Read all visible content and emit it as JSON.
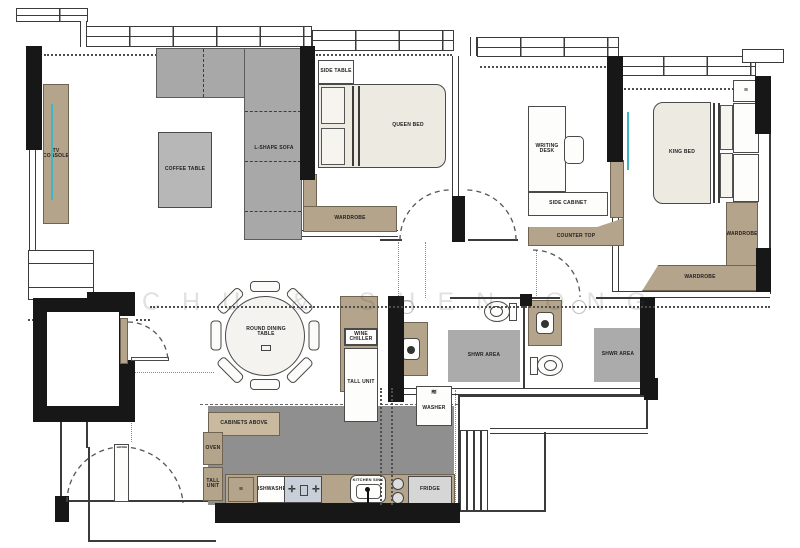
{
  "watermark": "CHU & SHEN ONG",
  "colors": {
    "wall": "#171717",
    "wood_tan": "#b4a48b",
    "upholstery_gray": "#a8a8a8",
    "bed_cream": "#edeae2",
    "accent_cyan": "#3fb6c4",
    "kitchen_floor": "#8f8f8f",
    "watermark_gray": "#d6d6d6"
  },
  "living": {
    "tv_console": "TV CONSOLE",
    "coffee_table": "COFFEE TABLE",
    "sofa": "L-SHAPE SOFA"
  },
  "bedroom2": {
    "side_table": "SIDE TABLE",
    "bed": "QUEEN BED",
    "wardrobe": "WARDROBE"
  },
  "study": {
    "desk": "WRITING DESK",
    "cabinet": "SIDE CABINET",
    "counter": "COUNTER TOP"
  },
  "master": {
    "bed": "KING BED",
    "bedside_glyph": "≡",
    "wardrobe_side": "WARDROBE",
    "wardrobe_bottom": "WARDROBE"
  },
  "dining": {
    "table": "ROUND DINING TABLE",
    "wine_chiller": "WINE CHILLER",
    "tall_unit": "TALL UNIT"
  },
  "bath_common": {
    "shower": "SHWR AREA"
  },
  "bath_master": {
    "shower": "SHWR AREA"
  },
  "kitchen": {
    "cabinets_above": "CABINETS ABOVE",
    "oven": "OVEN",
    "tall_unit": "TALL UNIT",
    "drawers_glyph": "≡",
    "dishwasher": "DISHWASHER",
    "sink": "KITCHEN SINK",
    "fridge": "FRIDGE",
    "washer": "WASHER",
    "washer_glyph": "≋"
  }
}
